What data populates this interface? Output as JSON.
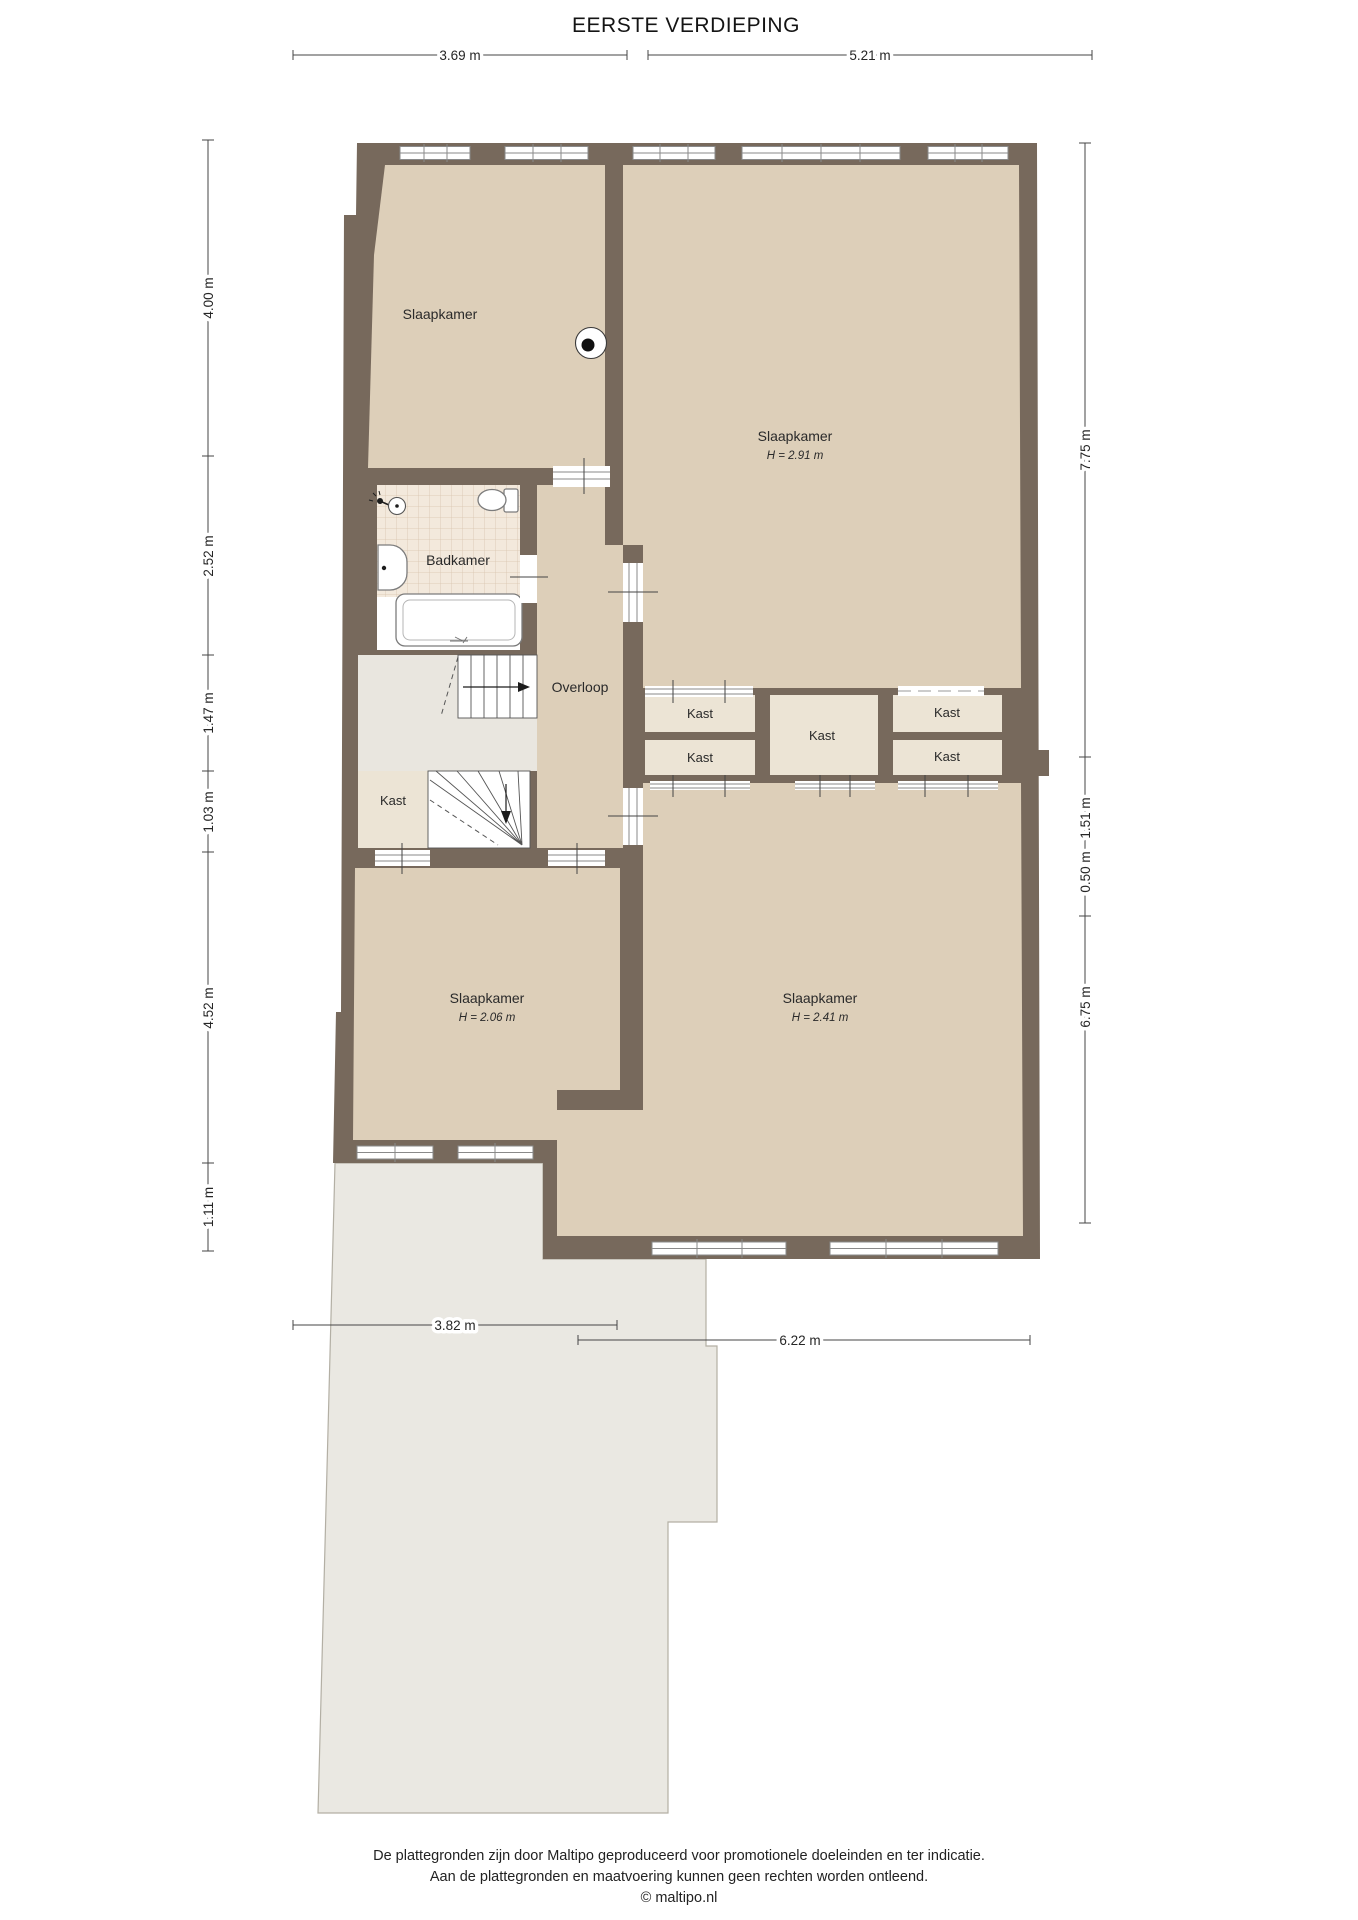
{
  "title": "EERSTE VERDIEPING",
  "rooms": {
    "bedroom_tl": {
      "label": "Slaapkamer"
    },
    "bedroom_tr": {
      "label": "Slaapkamer",
      "height": "H = 2.91 m"
    },
    "bedroom_bl": {
      "label": "Slaapkamer",
      "height": "H = 2.06 m"
    },
    "bedroom_br": {
      "label": "Slaapkamer",
      "height": "H = 2.41 m"
    },
    "bathroom": {
      "label": "Badkamer"
    },
    "landing": {
      "label": "Overloop"
    },
    "closet_by_stairs": {
      "label": "Kast"
    },
    "closets": [
      "Kast",
      "Kast",
      "Kast",
      "Kast",
      "Kast"
    ]
  },
  "dimensions": {
    "top": [
      "3.69 m",
      "5.21 m"
    ],
    "left": [
      "4.00 m",
      "2.52 m",
      "1.47 m",
      "1.03 m",
      "4.52 m",
      "1.11 m"
    ],
    "right": [
      "7.75 m",
      "1.51 m",
      "0.50 m",
      "6.75 m"
    ],
    "bottom": [
      "3.82 m",
      "6.22 m"
    ]
  },
  "footer": {
    "line1": "De plattegronden zijn door Maltipo geproduceerd voor promotionele doeleinden en ter indicatie.",
    "line2": "Aan de plattegronden en maatvoering kunnen geen rechten worden ontleend.",
    "line3": "© maltipo.nl"
  },
  "colors": {
    "wall": "#77695c",
    "room": "#ddcfb9",
    "closet": "#ece4d5",
    "landing": "#e9e6df",
    "roof": "#eae8e2",
    "roofline": "#b3afa4",
    "tilebg": "#f3e9dc",
    "tilegrid": "#d9c3ae"
  }
}
